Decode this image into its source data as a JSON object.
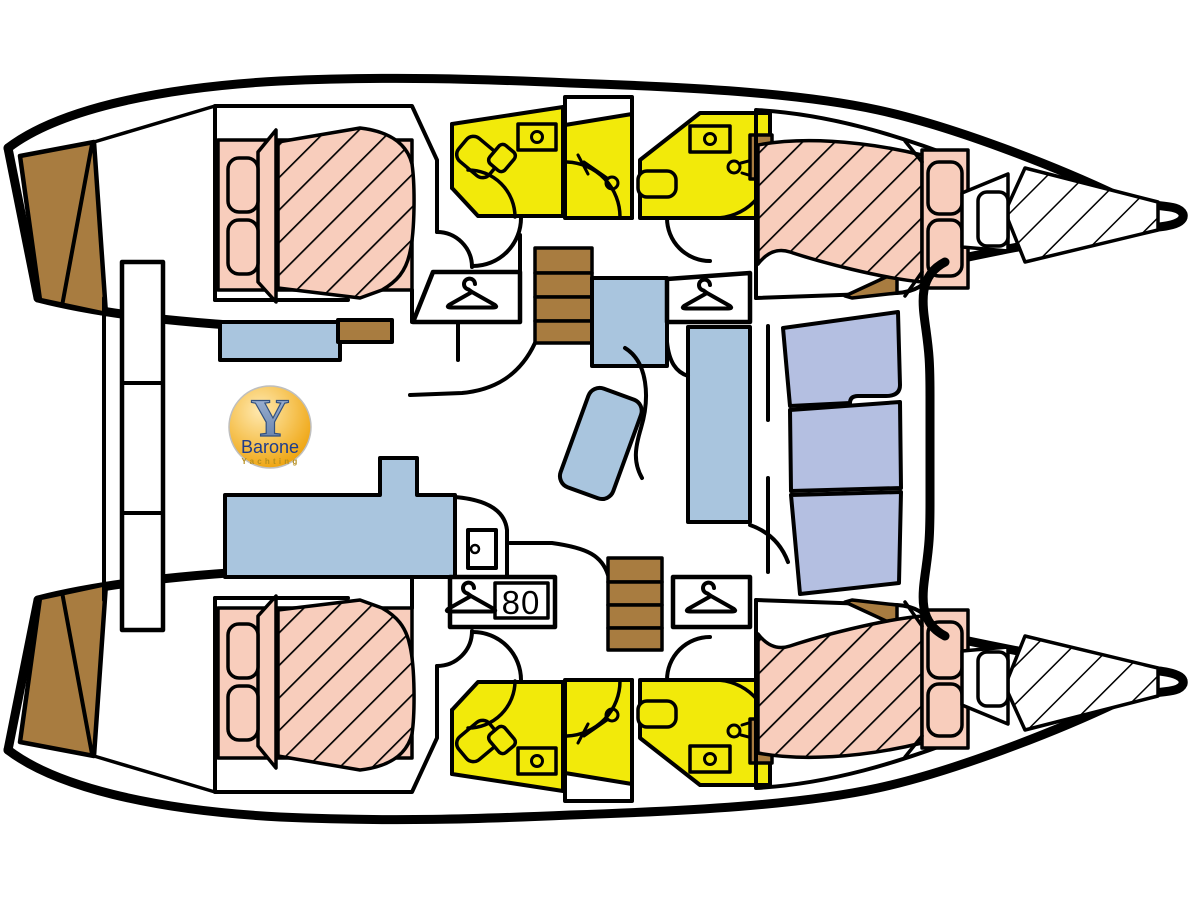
{
  "diagram": {
    "type": "catamaran-interior-floor-plan",
    "badge": {
      "value": "80"
    },
    "logo": {
      "monogram": "Y",
      "brand": "Barone",
      "subtitle": "Yachting"
    },
    "colors": {
      "line": "#000000",
      "bed_pink": "#F8CDBC",
      "bathroom_yellow": "#F2EA0A",
      "furniture_blue": "#A9C5DE",
      "bench_blue": "#B4BFE1",
      "wood_brown": "#A87C40",
      "logo_gold_dark": "#ED9D00",
      "logo_gold_mid": "#F7C860",
      "logo_gold_light": "#FFE9B0",
      "logo_y_top": "#A6BBD9",
      "logo_y_bottom": "#5F7AA6",
      "logo_brand_blue": "#1E3C8C",
      "logo_subtitle_gold": "#B68E1E"
    },
    "icons": [
      "hanger-icon",
      "shower-head-icon",
      "sink-icon",
      "toilet-icon",
      "door-icon",
      "steps-icon",
      "bed-icon",
      "hull-outline"
    ]
  }
}
